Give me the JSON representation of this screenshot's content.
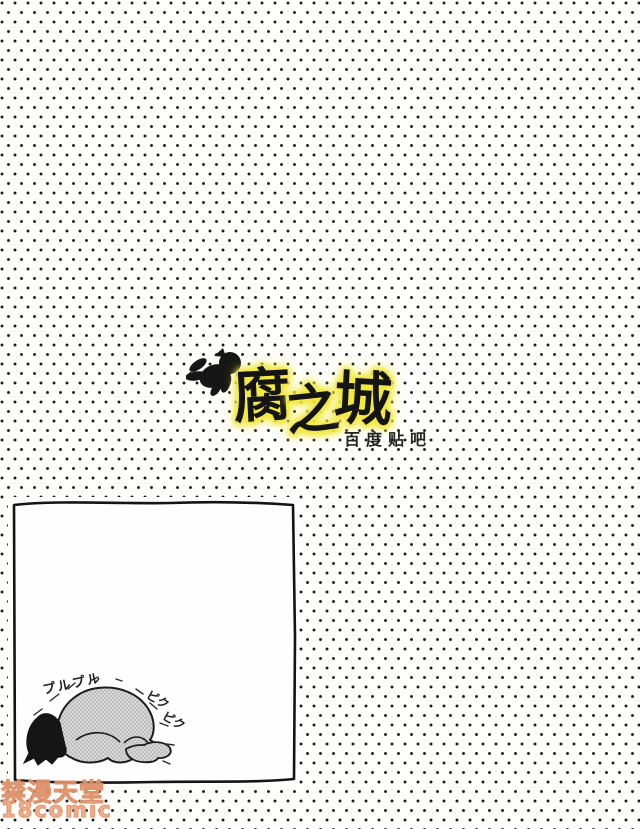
{
  "background": {
    "dot_color": "#1b1b1b",
    "paper_color": "#fdfdfb",
    "pattern": "staggered-halftone-dots"
  },
  "logo": {
    "title": "腐之城",
    "chars": [
      "腐",
      "之",
      "城"
    ],
    "subtitle": "百度贴吧",
    "highlight_color": "#f2e93f",
    "ink_color": "#141414",
    "cherub_icon": "flying-cherub-silhouette"
  },
  "panel": {
    "figure": "kneeling-trembling-figure",
    "sfx_left": "プルプル",
    "sfx_right": [
      "ピク",
      "ピク"
    ]
  },
  "watermark": {
    "line1": "禁漫天堂",
    "line2": "18comic",
    "color": "#f0ab84"
  }
}
